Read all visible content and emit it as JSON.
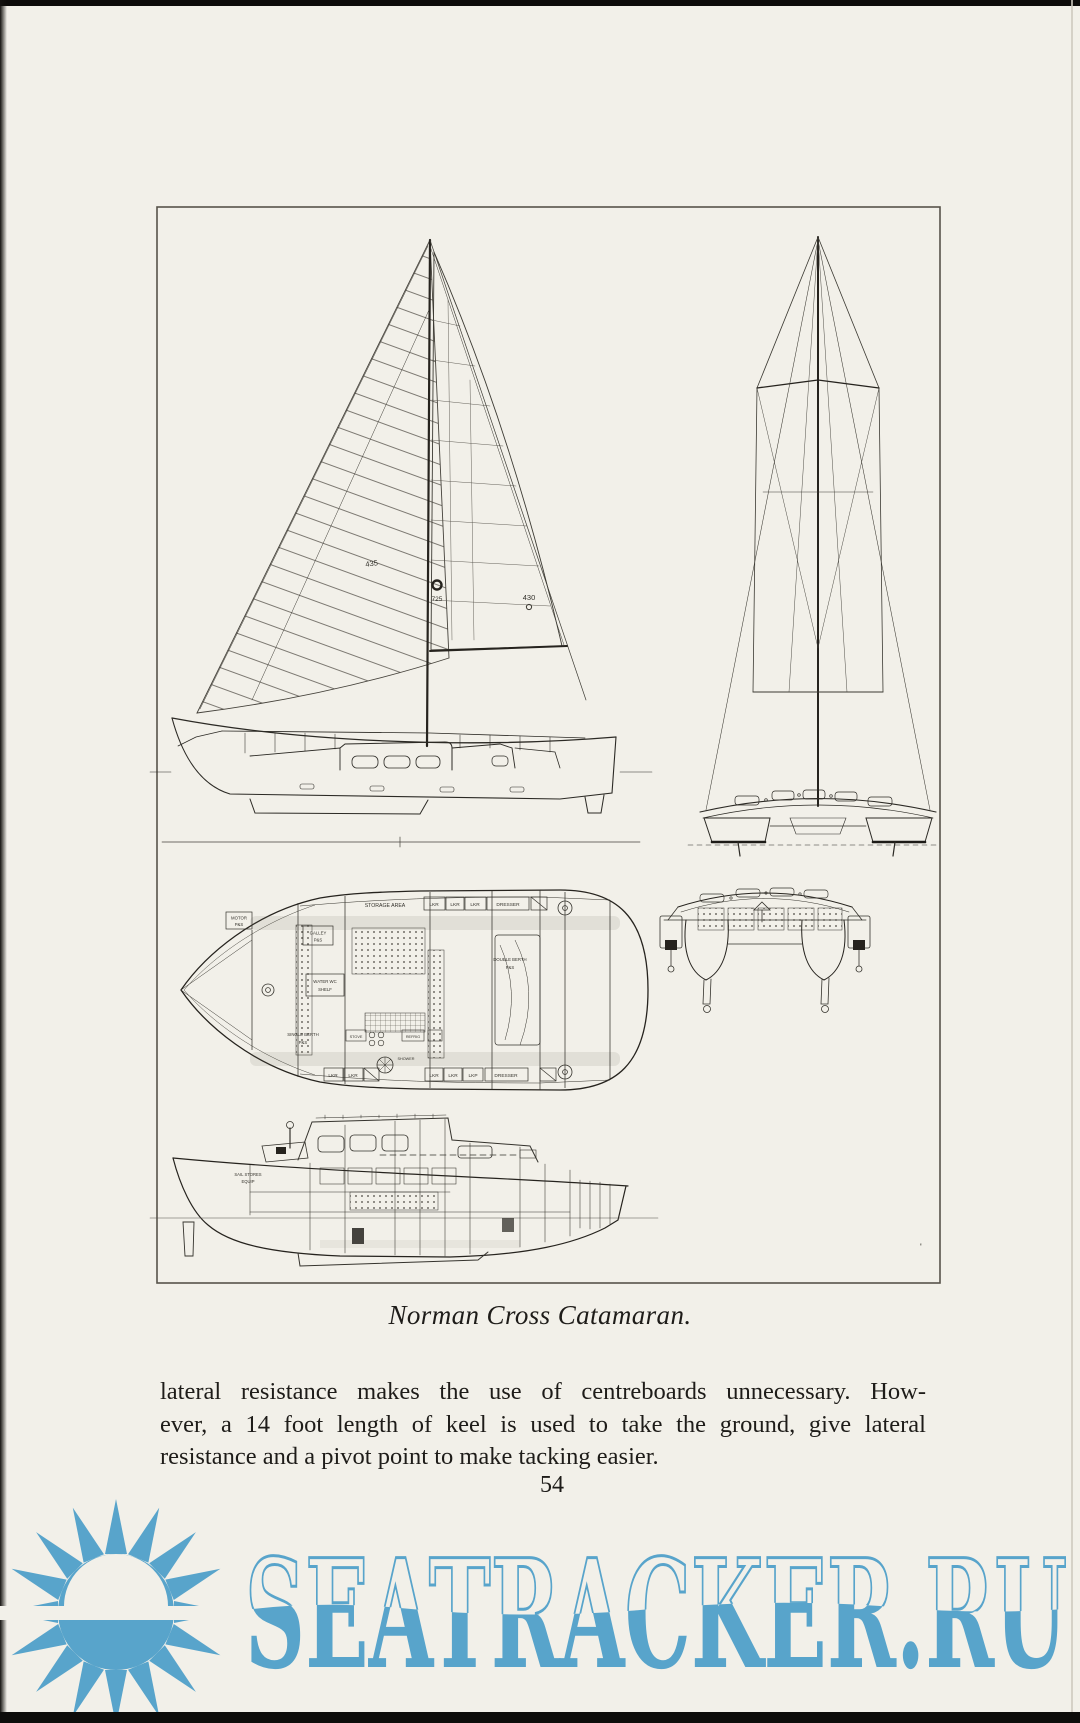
{
  "page": {
    "background_color": "#f2f0e9",
    "caption": "Norman Cross Catamaran.",
    "body_lines": [
      "lateral resistance makes the use of centreboards unnecessary.  How-",
      "ever, a 14 foot length of keel is used to take the ground, give lateral",
      "resistance and a pivot point to make tacking easier."
    ],
    "page_number": "54"
  },
  "figure": {
    "sail_plan": {
      "genoa_number": "435",
      "insignia_number": "725",
      "main_number": "430"
    },
    "deck_plan": {
      "storage_area": "STORAGE AREA",
      "lkr": "LKR",
      "lkp": "LKP",
      "dresser": "DRESSER",
      "motor": "MOTOR",
      "ps": "P&S",
      "galley": "GALLEY",
      "water_wc": "WATER WC",
      "shelf": "SHELF",
      "double_berth": "DOUBLE BERTH",
      "single_berth": "SINGLE BERTH",
      "stove": "STOVE",
      "refrig": "REFRIG",
      "shower": "SHOWER"
    },
    "profile": {
      "sail_stores": "SAIL STORES",
      "equip": "EQUIP",
      "tick_mark": "'"
    }
  },
  "watermark": {
    "text": "SEATRACKER.RU",
    "color": "#58a4cb",
    "icon": "sun-over-sea-icon"
  }
}
